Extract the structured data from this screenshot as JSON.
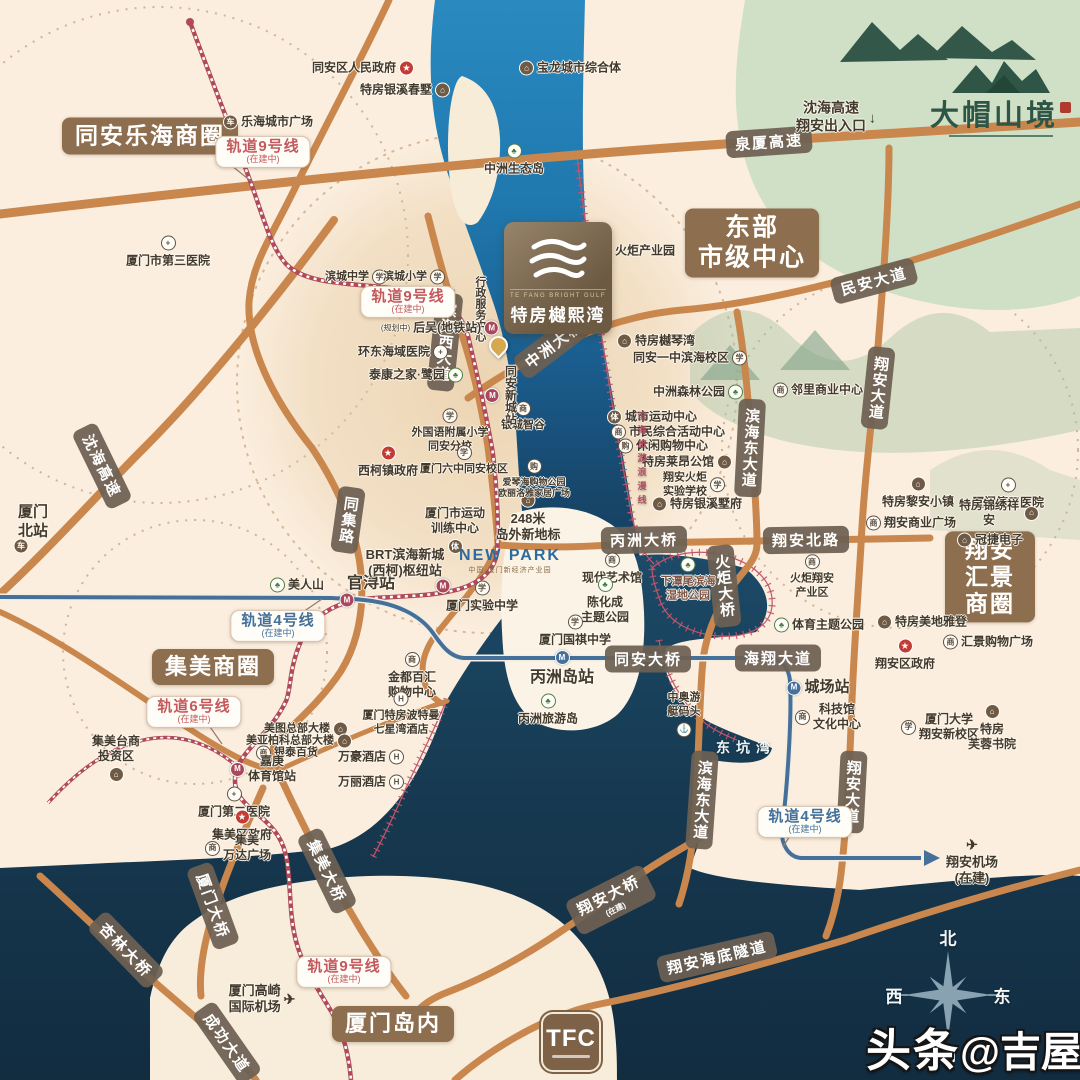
{
  "colors": {
    "land": "#fbeede",
    "water_deep": "#16384f",
    "river": "#2286bd",
    "road": "#c9874e",
    "rail9": "#b04a58",
    "rail4": "#44709a",
    "pill": "#6e6053",
    "badge": "#8d6e4e",
    "coast_line": "#c2566a"
  },
  "watermark": {
    "bold": "头条",
    "rest": "@吉屋网"
  },
  "compass": {
    "north": "北",
    "west": "西",
    "east": "东",
    "south": "南"
  },
  "project_logo": {
    "en": "TE FANG BRIGHT GULF",
    "name": "特房樾熙湾"
  },
  "corner_logo": {
    "name": "大帽山境"
  },
  "tfc": {
    "title": "TFC"
  },
  "newpark": {
    "title": "NEW PARK",
    "subtitle": "中国·厦门新经济产业园"
  },
  "badges": [
    {
      "t": "同安乐海商圈",
      "x": 150,
      "y": 136,
      "fs": 23
    },
    {
      "t": "东部\n市级中心",
      "x": 752,
      "y": 243,
      "fs": 25
    },
    {
      "t": "翔安\n汇景商圈",
      "x": 990,
      "y": 577,
      "fs": 23
    },
    {
      "t": "集美商圈",
      "x": 213,
      "y": 667,
      "fs": 22
    },
    {
      "t": "厦门岛内",
      "x": 393,
      "y": 1024,
      "fs": 22
    }
  ],
  "road_labels": [
    {
      "t": "泉厦高速",
      "x": 769,
      "y": 142,
      "r": -4
    },
    {
      "t": "沈海高速",
      "x": 102,
      "y": 466,
      "r": 64
    },
    {
      "t": "民安大道",
      "x": 874,
      "y": 281,
      "r": -15
    },
    {
      "t": "中洲大桥",
      "x": 554,
      "y": 344,
      "r": -37
    },
    {
      "t": "滨海西大道",
      "x": 445,
      "y": 342,
      "r": 6,
      "v": true
    },
    {
      "t": "同集路",
      "x": 348,
      "y": 520,
      "r": 8,
      "v": true
    },
    {
      "t": "滨海东大道",
      "x": 750,
      "y": 448,
      "r": 3,
      "v": true
    },
    {
      "t": "翔安大道",
      "x": 878,
      "y": 388,
      "r": 6,
      "v": true
    },
    {
      "t": "翔安北路",
      "x": 806,
      "y": 540,
      "r": -1
    },
    {
      "t": "丙洲大桥",
      "x": 644,
      "y": 540,
      "r": -1
    },
    {
      "t": "火炬大桥",
      "x": 724,
      "y": 586,
      "r": -6,
      "v": true
    },
    {
      "t": "同安大桥",
      "x": 648,
      "y": 659,
      "r": 0
    },
    {
      "t": "海翔大道",
      "x": 778,
      "y": 658,
      "r": 0
    },
    {
      "t": "滨海东大道",
      "x": 702,
      "y": 800,
      "r": 4,
      "v": true
    },
    {
      "t": "翔安大道",
      "x": 852,
      "y": 792,
      "r": 3,
      "v": true
    },
    {
      "t": "集美大桥",
      "x": 327,
      "y": 871,
      "r": 64
    },
    {
      "t": "厦门大桥",
      "x": 213,
      "y": 906,
      "r": 70
    },
    {
      "t": "杏林大桥",
      "x": 126,
      "y": 950,
      "r": 46
    },
    {
      "t": "成功大道",
      "x": 227,
      "y": 1043,
      "r": 55
    },
    {
      "t": "翔安大桥",
      "x": 611,
      "y": 900,
      "r": -27,
      "sub": "(在建)"
    },
    {
      "t": "翔安海底隧道",
      "x": 717,
      "y": 957,
      "r": -13
    }
  ],
  "rail_bubbles": [
    {
      "t": "轨道9号线",
      "sub": "(在建中)",
      "x": 263,
      "y": 152,
      "c": "#c4595c"
    },
    {
      "t": "轨道9号线",
      "sub": "(在建中)",
      "x": 408,
      "y": 302,
      "c": "#c4595c"
    },
    {
      "t": "轨道9号线",
      "sub": "(在建中)",
      "x": 344,
      "y": 972,
      "c": "#c4595c"
    },
    {
      "t": "轨道4号线",
      "sub": "(在建中)",
      "x": 278,
      "y": 626,
      "c": "#44709a"
    },
    {
      "t": "轨道4号线",
      "sub": "(在建中)",
      "x": 805,
      "y": 822,
      "c": "#44709a"
    },
    {
      "t": "轨道6号线",
      "sub": "(在建中)",
      "x": 194,
      "y": 712,
      "c": "#c4595c"
    }
  ],
  "icon_defs": {
    "school": {
      "g": "学",
      "k": "oc"
    },
    "hosp": {
      "g": "+",
      "k": "oc"
    },
    "bld": {
      "g": "⌂",
      "k": "fc"
    },
    "tree": {
      "g": "♣",
      "k": "gc"
    },
    "gov": {
      "g": "★",
      "k": "rc"
    },
    "mall": {
      "g": "商",
      "k": "oc"
    },
    "cart": {
      "g": "购",
      "k": "oc"
    },
    "hotel": {
      "g": "H",
      "k": "oc"
    },
    "plane": {
      "g": "✈",
      "k": "plain"
    },
    "train": {
      "g": "车",
      "k": "fc"
    },
    "sport": {
      "g": "体",
      "k": "fc"
    },
    "anchor": {
      "g": "⚓",
      "k": "oc"
    },
    "down": {
      "g": "↓",
      "k": "plain"
    },
    "m9": {
      "g": "M",
      "k": "mm m9c"
    },
    "m4": {
      "g": "M",
      "k": "mm m4c"
    }
  },
  "pois": [
    {
      "t": "同安区人民政府",
      "x": 363,
      "y": 68,
      "i": "gov",
      "p": "r"
    },
    {
      "t": "特房银溪春墅",
      "x": 405,
      "y": 90,
      "i": "bld",
      "p": "r"
    },
    {
      "t": "宝龙城市综合体",
      "x": 570,
      "y": 68,
      "i": "bld",
      "p": "l"
    },
    {
      "t": "中洲生态岛",
      "x": 514,
      "y": 160,
      "i": "tree",
      "p": "t"
    },
    {
      "t": "乐海城市广场",
      "x": 268,
      "y": 122,
      "i": "train",
      "p": "l"
    },
    {
      "t": "厦门市第三医院",
      "x": 168,
      "y": 252,
      "i": "hosp",
      "p": "t"
    },
    {
      "t": "滨城中学",
      "x": 356,
      "y": 277,
      "i": "school",
      "p": "r",
      "fs": 11
    },
    {
      "t": "滨城小学",
      "x": 414,
      "y": 277,
      "i": "school",
      "p": "r",
      "fs": 11
    },
    {
      "t": "火炬产业园",
      "x": 636,
      "y": 251,
      "i": "bld",
      "p": "l"
    },
    {
      "t": "行政服务中心",
      "x": 479,
      "y": 309,
      "v": true,
      "fs": 11
    },
    {
      "t": "后吴(地铁站)",
      "x": 440,
      "y": 328,
      "i": "m9",
      "p": "r",
      "sub": "(规划中)"
    },
    {
      "t": "环东海域医院",
      "x": 403,
      "y": 352,
      "i": "hosp",
      "p": "r"
    },
    {
      "t": "泰康之家·鹭园",
      "x": 416,
      "y": 375,
      "i": "tree",
      "p": "r"
    },
    {
      "t": "外国语附属小学\n同安分校",
      "x": 450,
      "y": 431,
      "i": "school",
      "p": "t",
      "fs": 11
    },
    {
      "t": "西柯镇政府",
      "x": 388,
      "y": 462,
      "i": "gov",
      "p": "t"
    },
    {
      "t": "厦门六中同安校区",
      "x": 464,
      "y": 461,
      "i": "school",
      "p": "t",
      "fs": 11
    },
    {
      "t": "银城智谷",
      "x": 523,
      "y": 417,
      "i": "mall",
      "p": "t",
      "fs": 11
    },
    {
      "t": "同安新城站",
      "x": 501,
      "y": 395,
      "v": true,
      "i": "m9",
      "p": "b"
    },
    {
      "t": "特房樾琴湾",
      "x": 656,
      "y": 341,
      "i": "bld",
      "p": "l"
    },
    {
      "t": "同安一中滨海校区",
      "x": 690,
      "y": 358,
      "i": "school",
      "p": "r"
    },
    {
      "t": "中洲森林公园",
      "x": 698,
      "y": 392,
      "i": "tree",
      "p": "r"
    },
    {
      "t": "城市运动中心",
      "x": 652,
      "y": 417,
      "i": "sport",
      "p": "l"
    },
    {
      "t": "市民综合活动中心",
      "x": 668,
      "y": 432,
      "i": "mall",
      "p": "l"
    },
    {
      "t": "休闲购物中心",
      "x": 663,
      "y": 446,
      "i": "cart",
      "p": "l"
    },
    {
      "t": "特房莱昂公馆",
      "x": 687,
      "y": 462,
      "i": "bld",
      "p": "r"
    },
    {
      "t": "翔安火炬\n实验学校",
      "x": 694,
      "y": 485,
      "i": "school",
      "p": "r",
      "fs": 11
    },
    {
      "t": "特房银溪墅府",
      "x": 697,
      "y": 504,
      "i": "bld",
      "p": "l"
    },
    {
      "t": "邻里商业中心",
      "x": 818,
      "y": 390,
      "i": "mall",
      "p": "l"
    },
    {
      "t": "特房黎安小镇",
      "x": 918,
      "y": 493,
      "i": "bld",
      "p": "t"
    },
    {
      "t": "厦门第五医院",
      "x": 1008,
      "y": 494,
      "i": "hosp",
      "p": "t"
    },
    {
      "t": "特房锦绣祥安",
      "x": 998,
      "y": 513,
      "i": "bld",
      "p": "r"
    },
    {
      "t": "翔安商业广场",
      "x": 911,
      "y": 523,
      "i": "mall",
      "p": "l"
    },
    {
      "t": "冠捷电子",
      "x": 990,
      "y": 540,
      "i": "bld",
      "p": "l"
    },
    {
      "t": "下潭尾滨海\n湿地公园",
      "x": 688,
      "y": 580,
      "i": "tree",
      "p": "t",
      "fs": 11,
      "c": "#7d5648"
    },
    {
      "t": "火炬翔安\n产业区",
      "x": 812,
      "y": 577,
      "i": "mall",
      "p": "t",
      "fs": 11
    },
    {
      "t": "体育主题公园",
      "x": 819,
      "y": 625,
      "i": "tree",
      "p": "l"
    },
    {
      "t": "特房美地雅登",
      "x": 922,
      "y": 622,
      "i": "bld",
      "p": "l"
    },
    {
      "t": "汇景购物广场",
      "x": 988,
      "y": 642,
      "i": "mall",
      "p": "l"
    },
    {
      "t": "翔安区政府",
      "x": 905,
      "y": 655,
      "i": "gov",
      "p": "t"
    },
    {
      "t": "城场站",
      "x": 818,
      "y": 688,
      "i": "m4",
      "p": "l",
      "fs": 15
    },
    {
      "t": "科技馆\n文化中心",
      "x": 828,
      "y": 717,
      "i": "mall",
      "p": "l"
    },
    {
      "t": "中奥游\n艇码头",
      "x": 684,
      "y": 714,
      "i": "anchor",
      "p": "b",
      "fs": 11
    },
    {
      "t": "厦门大学\n翔安新校区",
      "x": 940,
      "y": 727,
      "i": "school",
      "p": "l"
    },
    {
      "t": "特房\n芙蓉书院",
      "x": 992,
      "y": 728,
      "i": "bld",
      "p": "t"
    },
    {
      "t": "翔安机场\n(在建)",
      "x": 972,
      "y": 862,
      "i": "plane",
      "p": "t",
      "fs": 13
    },
    {
      "t": "东坑湾",
      "x": 746,
      "y": 748,
      "fs": 14,
      "c": "#eef6f8",
      "ls": 6,
      "nh": true
    },
    {
      "t": "美人山",
      "x": 297,
      "y": 585,
      "i": "tree",
      "p": "l"
    },
    {
      "t": "官浔站",
      "x": 371,
      "y": 584,
      "fs": 16
    },
    {
      "t": "",
      "x": 347,
      "y": 600,
      "i": "m9"
    },
    {
      "t": "",
      "x": 443,
      "y": 586,
      "i": "m9"
    },
    {
      "t": "BRT滨海新城\n(西柯)枢纽站",
      "x": 405,
      "y": 563,
      "fs": 13
    },
    {
      "t": "厦门市运动\n训练中心",
      "x": 455,
      "y": 530,
      "i": "sport",
      "p": "b"
    },
    {
      "t": "厦门实验中学",
      "x": 482,
      "y": 597,
      "i": "school",
      "p": "t"
    },
    {
      "t": "现代艺术馆",
      "x": 612,
      "y": 569,
      "i": "mall",
      "p": "t"
    },
    {
      "t": "陈化成\n主题公园",
      "x": 605,
      "y": 601,
      "i": "tree",
      "p": "t"
    },
    {
      "t": "厦门国祺中学",
      "x": 575,
      "y": 631,
      "i": "school",
      "p": "t"
    },
    {
      "t": "丙洲岛站",
      "x": 562,
      "y": 669,
      "i": "m4",
      "p": "t",
      "fs": 16
    },
    {
      "t": "丙洲旅游岛",
      "x": 548,
      "y": 710,
      "i": "tree",
      "p": "t"
    },
    {
      "t": "金都百汇\n购物中心",
      "x": 412,
      "y": 676,
      "i": "mall",
      "p": "t"
    },
    {
      "t": "厦门特房波特曼\n七星湾酒店",
      "x": 401,
      "y": 714,
      "i": "hotel",
      "p": "t",
      "fs": 11
    },
    {
      "t": "万豪酒店",
      "x": 371,
      "y": 757,
      "i": "hotel",
      "p": "r"
    },
    {
      "t": "万丽酒店",
      "x": 371,
      "y": 782,
      "i": "hotel",
      "p": "r"
    },
    {
      "t": "集美台商\n投资区",
      "x": 116,
      "y": 758,
      "i": "bld",
      "p": "b"
    },
    {
      "t": "美图总部大楼",
      "x": 306,
      "y": 729,
      "i": "bld",
      "p": "r",
      "fs": 11
    },
    {
      "t": "美亚柏科总部大楼",
      "x": 299,
      "y": 741,
      "i": "bld",
      "p": "r",
      "fs": 11
    },
    {
      "t": "银泰百货",
      "x": 287,
      "y": 753,
      "i": "mall",
      "p": "l",
      "fs": 11
    },
    {
      "t": "嘉庚\n体育馆站",
      "x": 263,
      "y": 769,
      "i": "m9",
      "p": "l"
    },
    {
      "t": "厦门第二医院",
      "x": 234,
      "y": 803,
      "i": "hosp",
      "p": "t"
    },
    {
      "t": "集美区政府",
      "x": 242,
      "y": 826,
      "i": "gov",
      "p": "t"
    },
    {
      "t": "集美\n万达广场",
      "x": 238,
      "y": 848,
      "i": "mall",
      "p": "l"
    },
    {
      "t": "厦门高崎\n国际机场",
      "x": 262,
      "y": 999,
      "i": "plane",
      "p": "r",
      "fs": 13
    },
    {
      "t": "厦门\n北站",
      "x": 33,
      "y": 522,
      "fs": 15
    },
    {
      "t": "",
      "x": 21,
      "y": 546,
      "i": "train"
    },
    {
      "t": "248米\n岛外新地标",
      "x": 528,
      "y": 518,
      "i": "bld",
      "p": "t",
      "fs": 13
    },
    {
      "t": "爱琴海购物公园\n欧丽洛雅家居广场",
      "x": 534,
      "y": 479,
      "i": "cart",
      "p": "t",
      "fs": 9
    },
    {
      "t": "沈海高速\n翔安出入口",
      "x": 836,
      "y": 117,
      "i": "down",
      "p": "r",
      "fs": 14
    },
    {
      "t": "滨海旅游浪漫线",
      "x": 641,
      "y": 460,
      "v": true,
      "fs": 9,
      "c": "#b05060",
      "ls": 5,
      "nh": true
    }
  ]
}
